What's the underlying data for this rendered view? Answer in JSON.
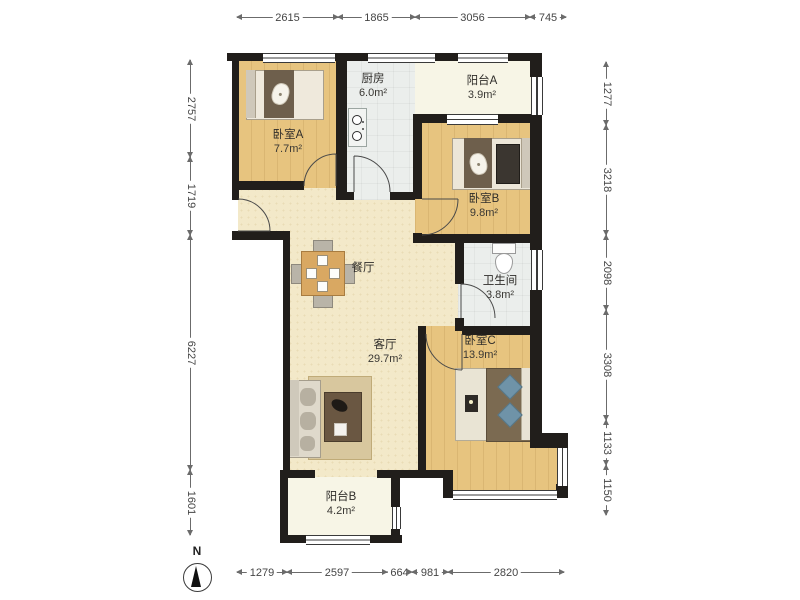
{
  "floor_plan": {
    "compass": {
      "label": "N"
    },
    "rooms": [
      {
        "name": "卧室A",
        "area": "7.7m²"
      },
      {
        "name": "厨房",
        "area": "6.0m²"
      },
      {
        "name": "阳台A",
        "area": "3.9m²"
      },
      {
        "name": "卧室B",
        "area": "9.8m²"
      },
      {
        "name": "餐厅",
        "area": ""
      },
      {
        "name": "卫生间",
        "area": "3.8m²"
      },
      {
        "name": "客厅",
        "area": "29.7m²"
      },
      {
        "name": "卧室C",
        "area": "13.9m²"
      },
      {
        "name": "阳台B",
        "area": "4.2m²"
      }
    ],
    "dimensions": {
      "top": [
        "2615",
        "1865",
        "3056",
        "745"
      ],
      "left": [
        "2757",
        "1719",
        "6227",
        "1601"
      ],
      "right": [
        "1277",
        "3218",
        "2098",
        "3308",
        "1133",
        "1150"
      ],
      "bottom": [
        "1279",
        "2597",
        "664",
        "981",
        "2820"
      ]
    },
    "colors": {
      "wall": "#211e1b",
      "wood_floor": "#e7c47f",
      "public_floor": "#f3e9c9",
      "tile_floor": "#ebeeec",
      "balcony_floor": "#f7f5e6",
      "dimension_text": "#454545"
    }
  }
}
